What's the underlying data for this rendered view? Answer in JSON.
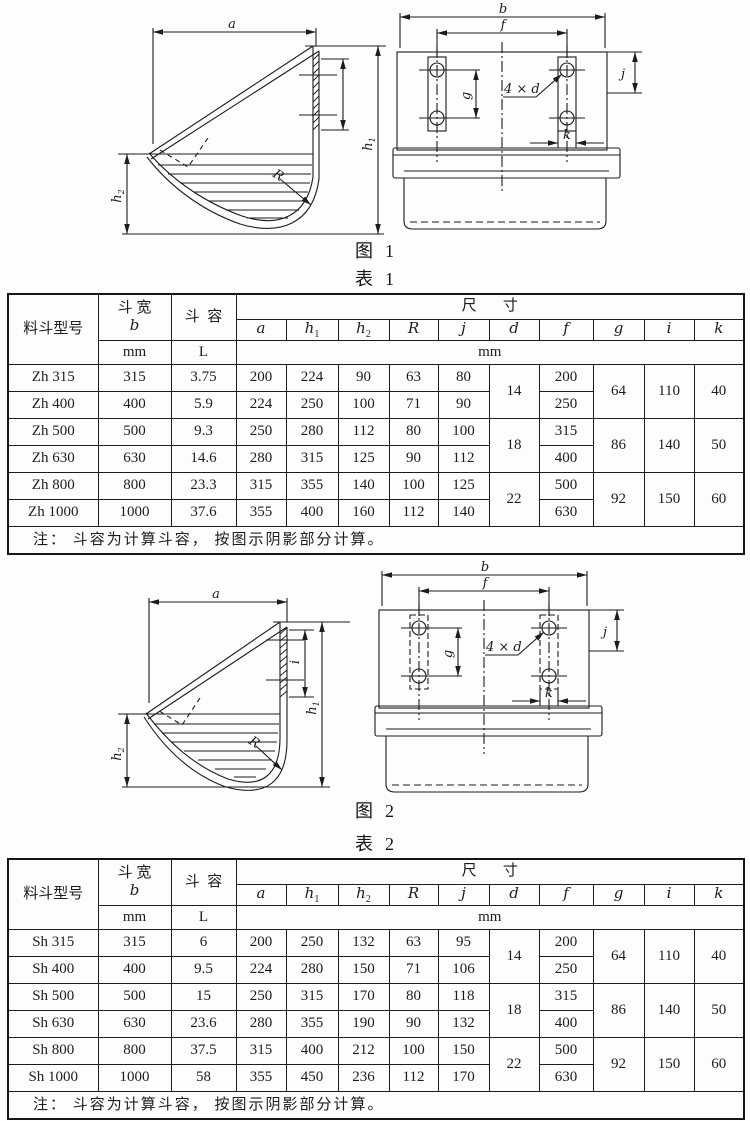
{
  "page": {
    "background": "#fdfdfd",
    "ink": "#1c1c1c"
  },
  "figure1": {
    "caption": "图  1",
    "table_caption": "表  1"
  },
  "figure2": {
    "caption": "图  2",
    "table_caption": "表  2"
  },
  "fig_labels": {
    "a": "a",
    "h_base": "h",
    "sub1": "1",
    "sub2": "2",
    "R": "R",
    "i": "i",
    "b": "b",
    "f": "f",
    "holes": "4 × d",
    "g": "g",
    "j": "j",
    "k": "k"
  },
  "table_header": {
    "model": "料斗型号",
    "width_cn": "斗 宽",
    "width_letter": "b",
    "capacity_cn": "斗  容",
    "dims_cn": "尺       寸",
    "unit_mm": "mm",
    "unit_L": "L",
    "dim_letters": [
      {
        "base": "a",
        "sub": ""
      },
      {
        "base": "h",
        "sub": "1"
      },
      {
        "base": "h",
        "sub": "2"
      },
      {
        "base": "R",
        "sub": ""
      },
      {
        "base": "j",
        "sub": ""
      },
      {
        "base": "d",
        "sub": ""
      },
      {
        "base": "f",
        "sub": ""
      },
      {
        "base": "g",
        "sub": ""
      },
      {
        "base": "i",
        "sub": ""
      },
      {
        "base": "k",
        "sub": ""
      }
    ]
  },
  "table1": {
    "rows": [
      {
        "model": "Zh 315",
        "b": "315",
        "cap": "3.75",
        "a": "200",
        "h1": "224",
        "h2": "90",
        "R": "63",
        "j": "80",
        "f": "200"
      },
      {
        "model": "Zh 400",
        "b": "400",
        "cap": "5.9",
        "a": "224",
        "h1": "250",
        "h2": "100",
        "R": "71",
        "j": "90",
        "f": "250"
      },
      {
        "model": "Zh 500",
        "b": "500",
        "cap": "9.3",
        "a": "250",
        "h1": "280",
        "h2": "112",
        "R": "80",
        "j": "100",
        "f": "315"
      },
      {
        "model": "Zh 630",
        "b": "630",
        "cap": "14.6",
        "a": "280",
        "h1": "315",
        "h2": "125",
        "R": "90",
        "j": "112",
        "f": "400"
      },
      {
        "model": "Zh 800",
        "b": "800",
        "cap": "23.3",
        "a": "315",
        "h1": "355",
        "h2": "140",
        "R": "100",
        "j": "125",
        "f": "500"
      },
      {
        "model": "Zh 1000",
        "b": "1000",
        "cap": "37.6",
        "a": "355",
        "h1": "400",
        "h2": "160",
        "R": "112",
        "j": "140",
        "f": "630"
      }
    ],
    "groups": [
      {
        "d": "14",
        "g": "64",
        "i": "110",
        "k": "40"
      },
      {
        "d": "18",
        "g": "86",
        "i": "140",
        "k": "50"
      },
      {
        "d": "22",
        "g": "92",
        "i": "150",
        "k": "60"
      }
    ],
    "note": "注： 斗容为计算斗容， 按图示阴影部分计算。"
  },
  "table2": {
    "rows": [
      {
        "model": "Sh 315",
        "b": "315",
        "cap": "6",
        "a": "200",
        "h1": "250",
        "h2": "132",
        "R": "63",
        "j": "95",
        "f": "200"
      },
      {
        "model": "Sh 400",
        "b": "400",
        "cap": "9.5",
        "a": "224",
        "h1": "280",
        "h2": "150",
        "R": "71",
        "j": "106",
        "f": "250"
      },
      {
        "model": "Sh 500",
        "b": "500",
        "cap": "15",
        "a": "250",
        "h1": "315",
        "h2": "170",
        "R": "80",
        "j": "118",
        "f": "315"
      },
      {
        "model": "Sh 630",
        "b": "630",
        "cap": "23.6",
        "a": "280",
        "h1": "355",
        "h2": "190",
        "R": "90",
        "j": "132",
        "f": "400"
      },
      {
        "model": "Sh 800",
        "b": "800",
        "cap": "37.5",
        "a": "315",
        "h1": "400",
        "h2": "212",
        "R": "100",
        "j": "150",
        "f": "500"
      },
      {
        "model": "Sh 1000",
        "b": "1000",
        "cap": "58",
        "a": "355",
        "h1": "450",
        "h2": "236",
        "R": "112",
        "j": "170",
        "f": "630"
      }
    ],
    "groups": [
      {
        "d": "14",
        "g": "64",
        "i": "110",
        "k": "40"
      },
      {
        "d": "18",
        "g": "86",
        "i": "140",
        "k": "50"
      },
      {
        "d": "22",
        "g": "92",
        "i": "150",
        "k": "60"
      }
    ],
    "note": "注： 斗容为计算斗容， 按图示阴影部分计算。"
  }
}
